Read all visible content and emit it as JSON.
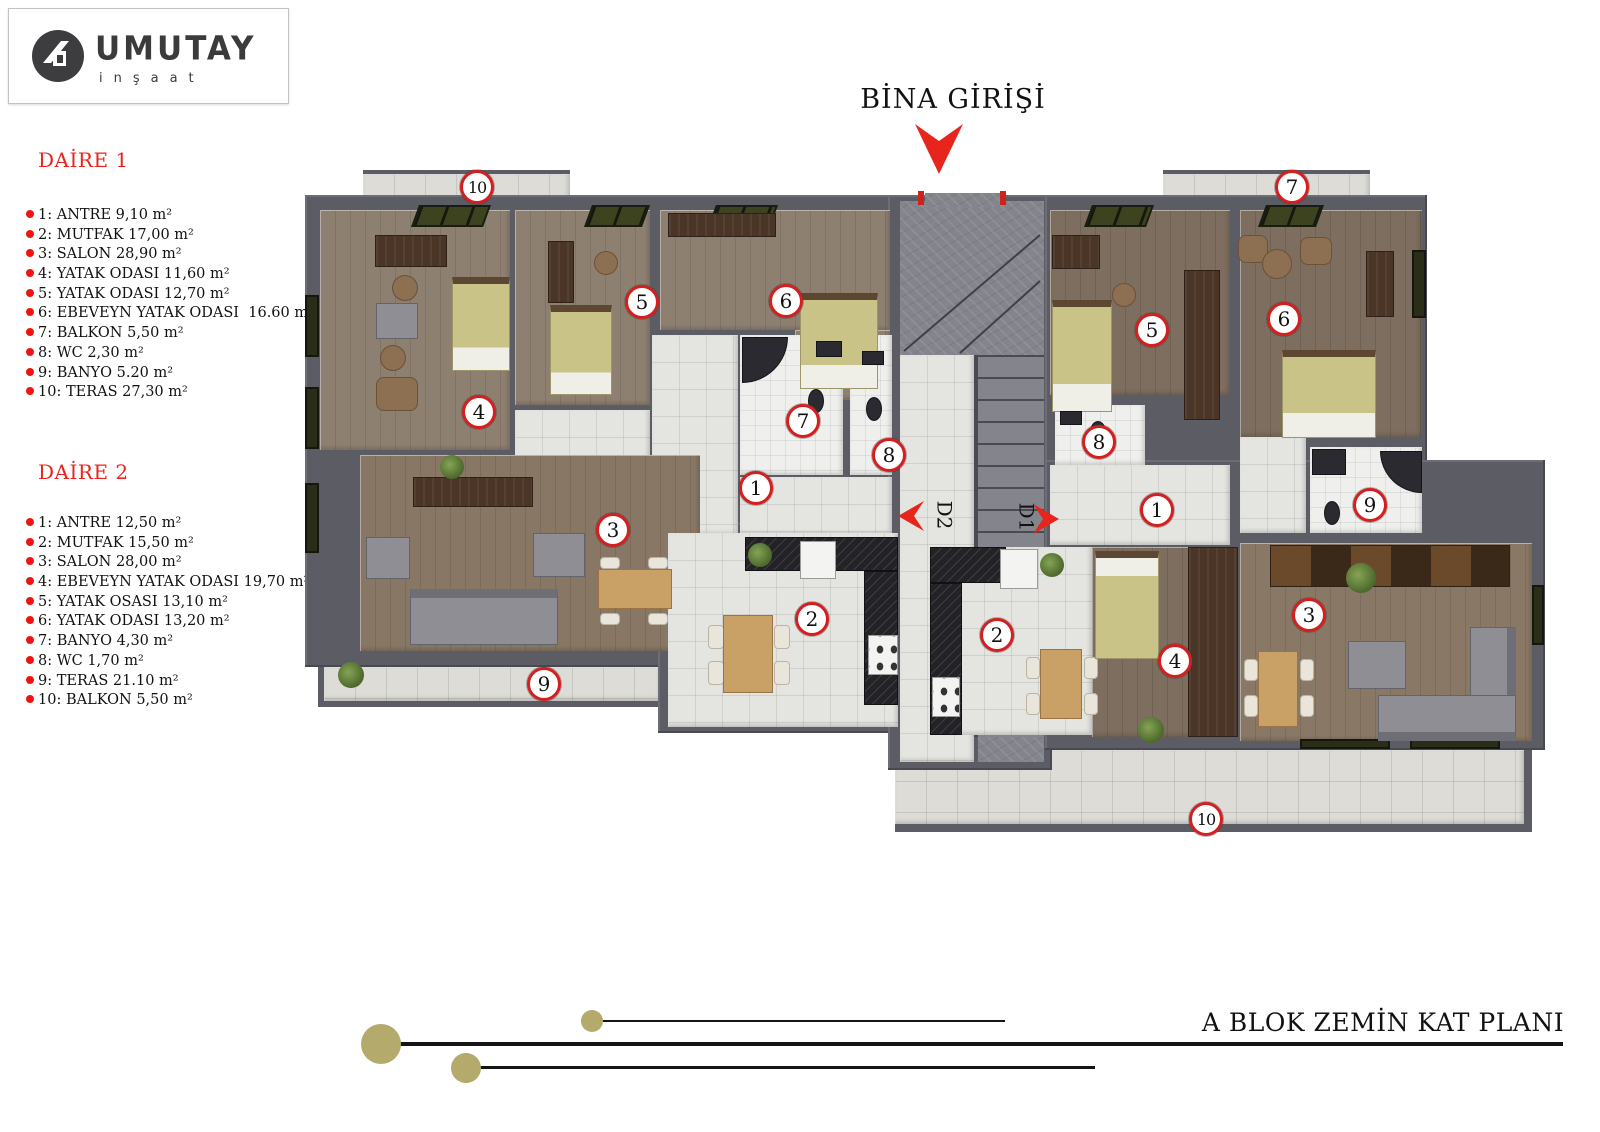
{
  "logo": {
    "brand": "UMUTAY",
    "sub": "inşaat"
  },
  "entrance": {
    "label": "BİNA GİRİŞİ"
  },
  "footer": {
    "title": "A BLOK ZEMİN KAT PLANI"
  },
  "apartments": [
    {
      "title": "DAİRE 1",
      "items": [
        "1: ANTRE 9,10 m²",
        "2: MUTFAK 17,00 m²",
        "3: SALON 28,90 m²",
        "4: YATAK ODASI 11,60 m²",
        "5: YATAK ODASI 12,70 m²",
        "6: EBEVEYN YATAK ODASI  16.60 m²",
        "7: BALKON 5,50 m²",
        "8: WC 2,30 m²",
        "9: BANYO 5.20 m²",
        "10: TERAS 27,30 m²"
      ]
    },
    {
      "title": "DAİRE 2",
      "items": [
        "1: ANTRE 12,50 m²",
        "2: MUTFAK 15,50 m²",
        "3: SALON 28,00 m²",
        "4: EBEVEYN YATAK ODASI 19,70 m²",
        "5: YATAK OSASI 13,10 m²",
        "6: YATAK ODASI 13,20 m²",
        "7: BANYO 4,30 m²",
        "8: WC 1,70 m²",
        "9: TERAS 21.10 m²",
        "10: BALKON 5,50 m²"
      ]
    }
  ],
  "doors": [
    {
      "label": "D2"
    },
    {
      "label": "D1"
    }
  ],
  "markers": [
    {
      "apt": "d1",
      "n": "10",
      "x": 177,
      "y": 22
    },
    {
      "apt": "d1",
      "n": "5",
      "x": 342,
      "y": 137
    },
    {
      "apt": "d1",
      "n": "6",
      "x": 486,
      "y": 136
    },
    {
      "apt": "d1",
      "n": "4",
      "x": 179,
      "y": 247
    },
    {
      "apt": "d1",
      "n": "7",
      "x": 503,
      "y": 256
    },
    {
      "apt": "d1",
      "n": "8",
      "x": 589,
      "y": 290
    },
    {
      "apt": "d1",
      "n": "1",
      "x": 456,
      "y": 323
    },
    {
      "apt": "d1",
      "n": "3",
      "x": 313,
      "y": 365
    },
    {
      "apt": "d1",
      "n": "2",
      "x": 512,
      "y": 454
    },
    {
      "apt": "d1",
      "n": "9",
      "x": 244,
      "y": 519
    },
    {
      "apt": "d2",
      "n": "7",
      "x": 992,
      "y": 22
    },
    {
      "apt": "d2",
      "n": "5",
      "x": 852,
      "y": 165
    },
    {
      "apt": "d2",
      "n": "6",
      "x": 984,
      "y": 154
    },
    {
      "apt": "d2",
      "n": "8",
      "x": 799,
      "y": 277
    },
    {
      "apt": "d2",
      "n": "1",
      "x": 857,
      "y": 345
    },
    {
      "apt": "d2",
      "n": "9",
      "x": 1070,
      "y": 340
    },
    {
      "apt": "d2",
      "n": "2",
      "x": 697,
      "y": 470
    },
    {
      "apt": "d2",
      "n": "4",
      "x": 875,
      "y": 496
    },
    {
      "apt": "d2",
      "n": "3",
      "x": 1009,
      "y": 450
    },
    {
      "apt": "d2",
      "n": "10",
      "x": 906,
      "y": 654
    }
  ],
  "colors": {
    "accent_red": "#e8251d",
    "bullet_red": "#f21212",
    "marker_ring": "#d51f1f",
    "wall_gray": "#5c5c64",
    "dec_olive": "#b3aa6b"
  }
}
